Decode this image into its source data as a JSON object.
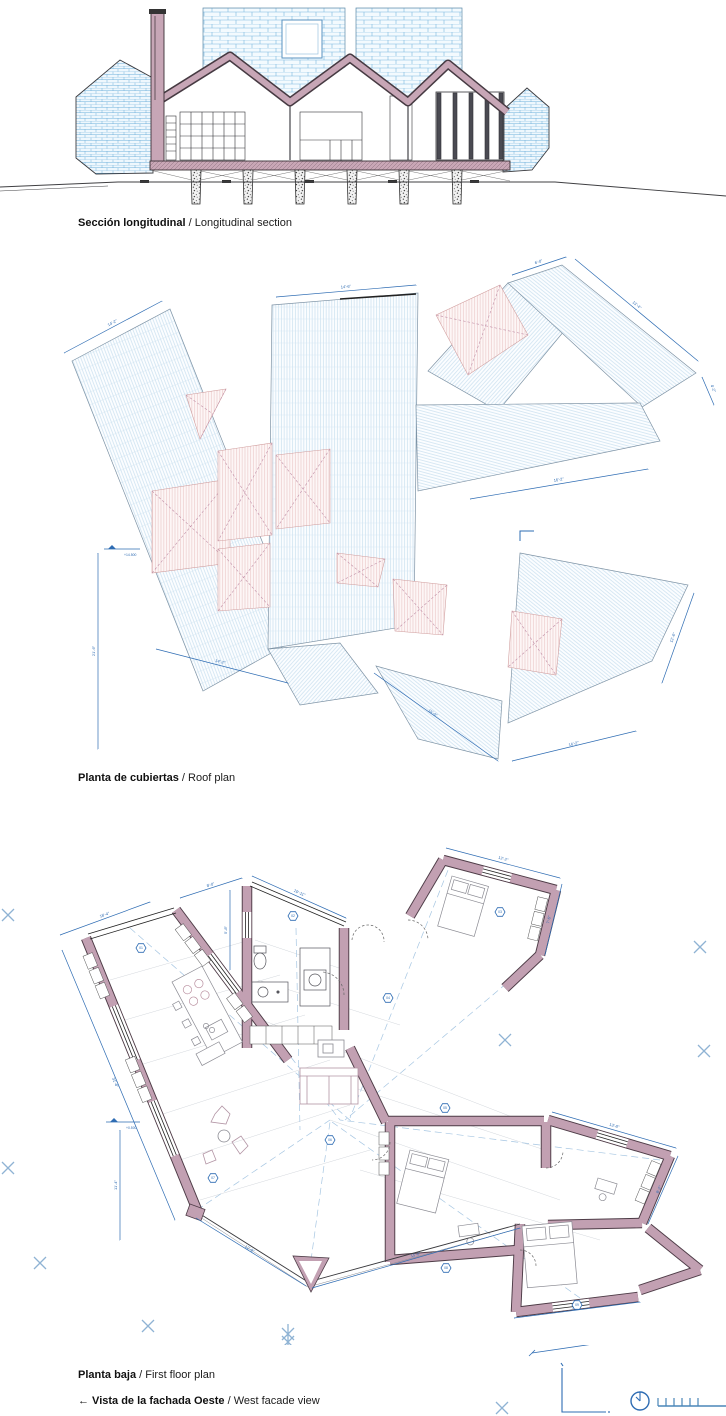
{
  "captions": {
    "section": {
      "bold": "Sección longitudinal",
      "rest": " / Longitudinal section"
    },
    "roof": {
      "bold": "Planta de cubiertas",
      "rest": " / Roof plan"
    },
    "plan": {
      "bold": "Planta baja",
      "rest": " / First floor plan"
    },
    "facade": {
      "bold": "← Vista de la fachada Oeste",
      "rest": " / West facade view"
    }
  },
  "roof": {
    "elevation": "+14.500",
    "dims": {
      "r1": "14'-2\"",
      "r2": "21'-6\"",
      "r3": "14'-6\"",
      "r4": "6'-0\"",
      "r5": "13'-4\"",
      "r6": "4'-2\"",
      "r7": "16'-2\"",
      "r8": "12'-6\"",
      "r9": "16'-2\"",
      "r10": "14'-2\"",
      "r11": "15'-0\""
    }
  },
  "plan": {
    "elevation": "+0.500",
    "dims": {
      "d1": "18'-4\"",
      "d2": "31'-6\"",
      "d4": "8'-0\"",
      "d5": "10'-11\"",
      "d6": "5'-8\"",
      "d8": "12'-2\"",
      "d9": "7'-6\"",
      "d11": "13'-8\"",
      "d12": "8'-2\"",
      "d13": "16'-2\"",
      "d14": "12'-9\"",
      "d15": "15'-0\"",
      "d16": "11'-4\""
    },
    "tags": {
      "t1": "01",
      "t2": "02",
      "t3": "03",
      "t4": "04",
      "t5": "05",
      "t6": "06",
      "t7": "07",
      "t8": "08",
      "t9": "09"
    }
  },
  "colors": {
    "dim_blue": "#2e6cb3",
    "marker_blue": "#8fb3d4",
    "shingle_blue": "#79b6df",
    "wall_pink": "#c2a0b2",
    "wall_outline": "#4d3b46",
    "ink": "#2b2b2e"
  }
}
